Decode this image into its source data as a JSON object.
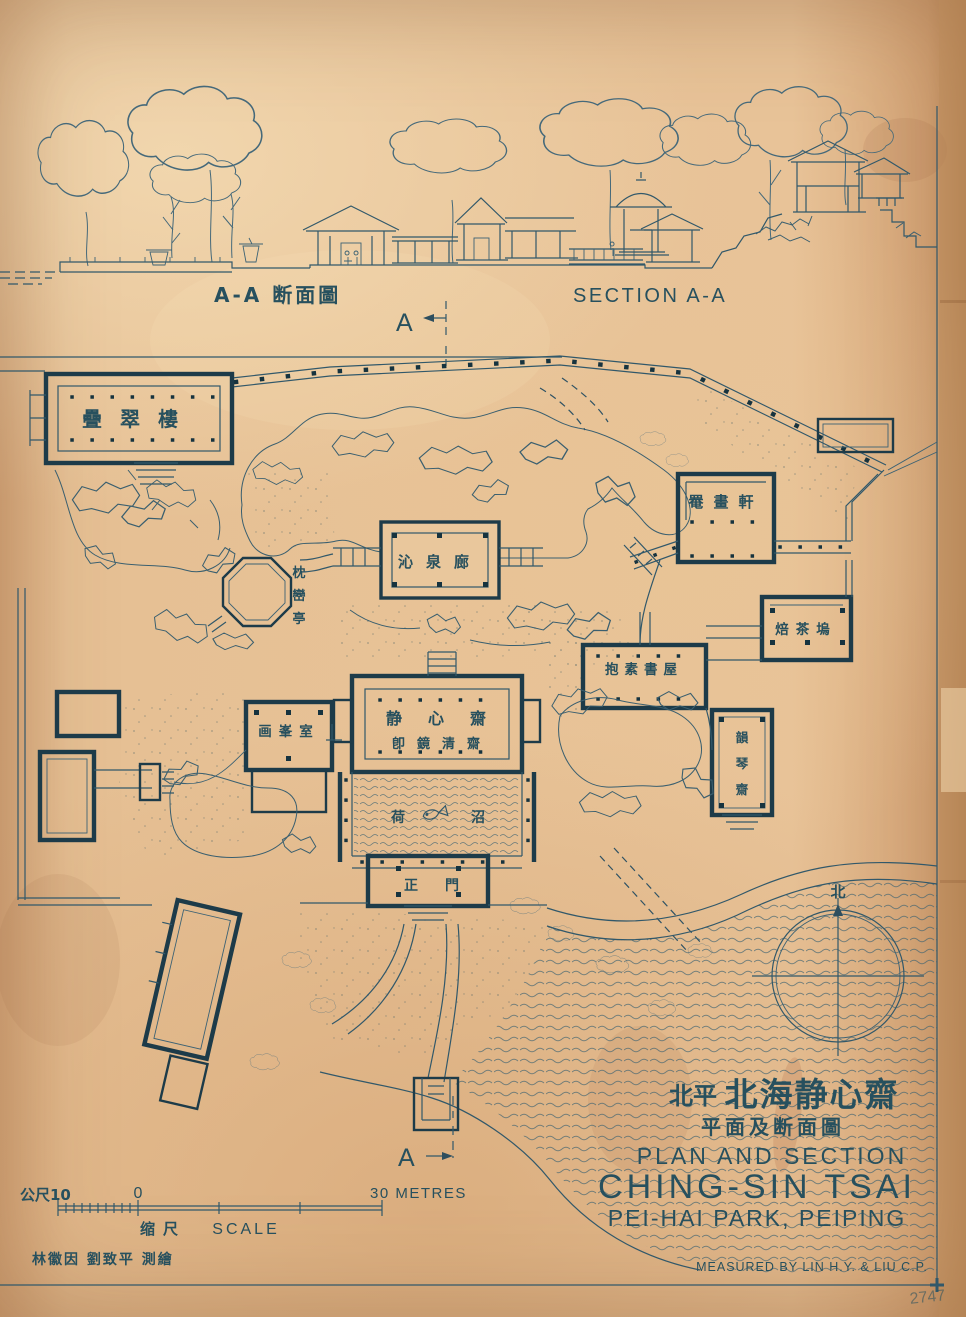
{
  "section": {
    "marker_top": "A",
    "marker_bottom": "A",
    "label_zh": "A-A 断面圖",
    "label_en": "SECTION A-A"
  },
  "plan": {
    "die_cui_lou": "疊翠樓",
    "yan_hua_xuan": "罨畫軒",
    "qin_quan_lang": "沁泉廊",
    "zhen_luan_ting": [
      "枕",
      "巒",
      "亭"
    ],
    "bei_cha_wu": "焙茶塢",
    "bao_su_shu_wu": "抱素書屋",
    "jing_xin_zhai": "静心齋",
    "jing_xin_zhai_alias": "卽鏡清齋",
    "hua_feng_shi": "画峯室",
    "he_zhao": [
      "荷",
      "沼"
    ],
    "zheng_men": [
      "正",
      "門"
    ],
    "yun_qin_zhai": [
      "韻",
      "琴",
      "齋"
    ],
    "north_label": "北"
  },
  "scale_bar": {
    "metric_label": "公尺10",
    "zero_label": "0",
    "end_label": "30 METRES",
    "caption_zh": "缩尺",
    "caption_en": "SCALE"
  },
  "title_block": {
    "region_zh": "北平",
    "name_zh": "北海静心齋",
    "subtitle_zh": "平面及断面圖",
    "line1": "PLAN AND SECTION",
    "line2": "CHING-SIN TSAI",
    "line3": "PEI-HAI PARK, PEIPING",
    "credit": "MEASURED BY LIN H.Y. & LIU C.P."
  },
  "credits": {
    "signature_zh": "林徽因 劉致平 測繪",
    "pencil_note": "2747"
  },
  "colors": {
    "ink": "#2e4e5e",
    "paper": "#e2ba8e"
  }
}
